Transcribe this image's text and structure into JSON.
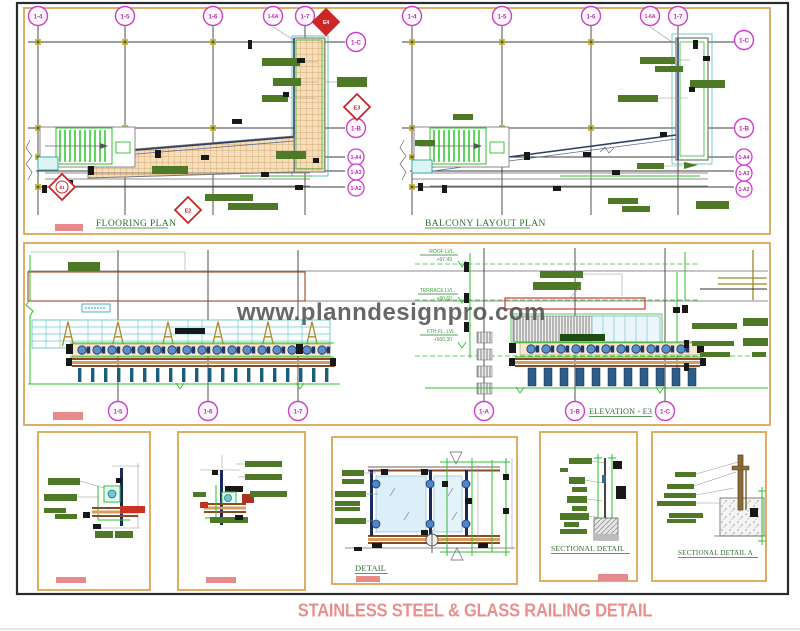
{
  "sheet": {
    "title": "STAINLESS STEEL & GLASS RAILING DETAIL",
    "watermark": "www.planndesignpro.com"
  },
  "flooring_plan": {
    "title": "FLOORING PLAN",
    "grid_top": [
      "1-4",
      "1-5",
      "1-6",
      "1-6A",
      "1-7"
    ],
    "grid_right": [
      "1-C",
      "1-B",
      "1-A4",
      "1-A3",
      "1-A2"
    ],
    "markers": {
      "e1": "E1",
      "e2": "E2",
      "e3": "E3",
      "e4": "E4"
    }
  },
  "balcony_plan": {
    "title": "BALCONY LAYOUT PLAN",
    "grid_top": [
      "1-4",
      "1-5",
      "1-6",
      "1-6A",
      "1-7"
    ],
    "grid_right": [
      "1-C",
      "1-B",
      "1-A4",
      "1-A3",
      "1-A2"
    ]
  },
  "elevation": {
    "title": "ELEVATION - E3",
    "grid_bottom_left": [
      "1-5",
      "1-6",
      "1-7"
    ],
    "grid_bottom_right": [
      "1-A",
      "1-B",
      "1-C"
    ],
    "levels": [
      {
        "name": "ROOF LVL.",
        "value": "+97.49"
      },
      {
        "name": "TERRACE LVL.",
        "value": "+90.60"
      },
      {
        "name": "6TH FL. LVL",
        "value": "+600.30"
      }
    ]
  },
  "details": {
    "detail_title": "DETAIL",
    "sectional_detail_title": "SECTIONAL DETAIL",
    "sectional_detail_a_title": "SECTIONAL DETAIL A"
  },
  "colors": {
    "panel_border": "#dca455",
    "grid_bubble": "#b832b8",
    "marker_red": "#cc2626",
    "annotation_green": "#4e7a28",
    "bright_green": "#2fbf2f",
    "hatch_tan": "#f5debc",
    "salmon": "#e8898c",
    "watermark_gray": "#4d4d4d",
    "title_salmon": "#e9908f"
  }
}
